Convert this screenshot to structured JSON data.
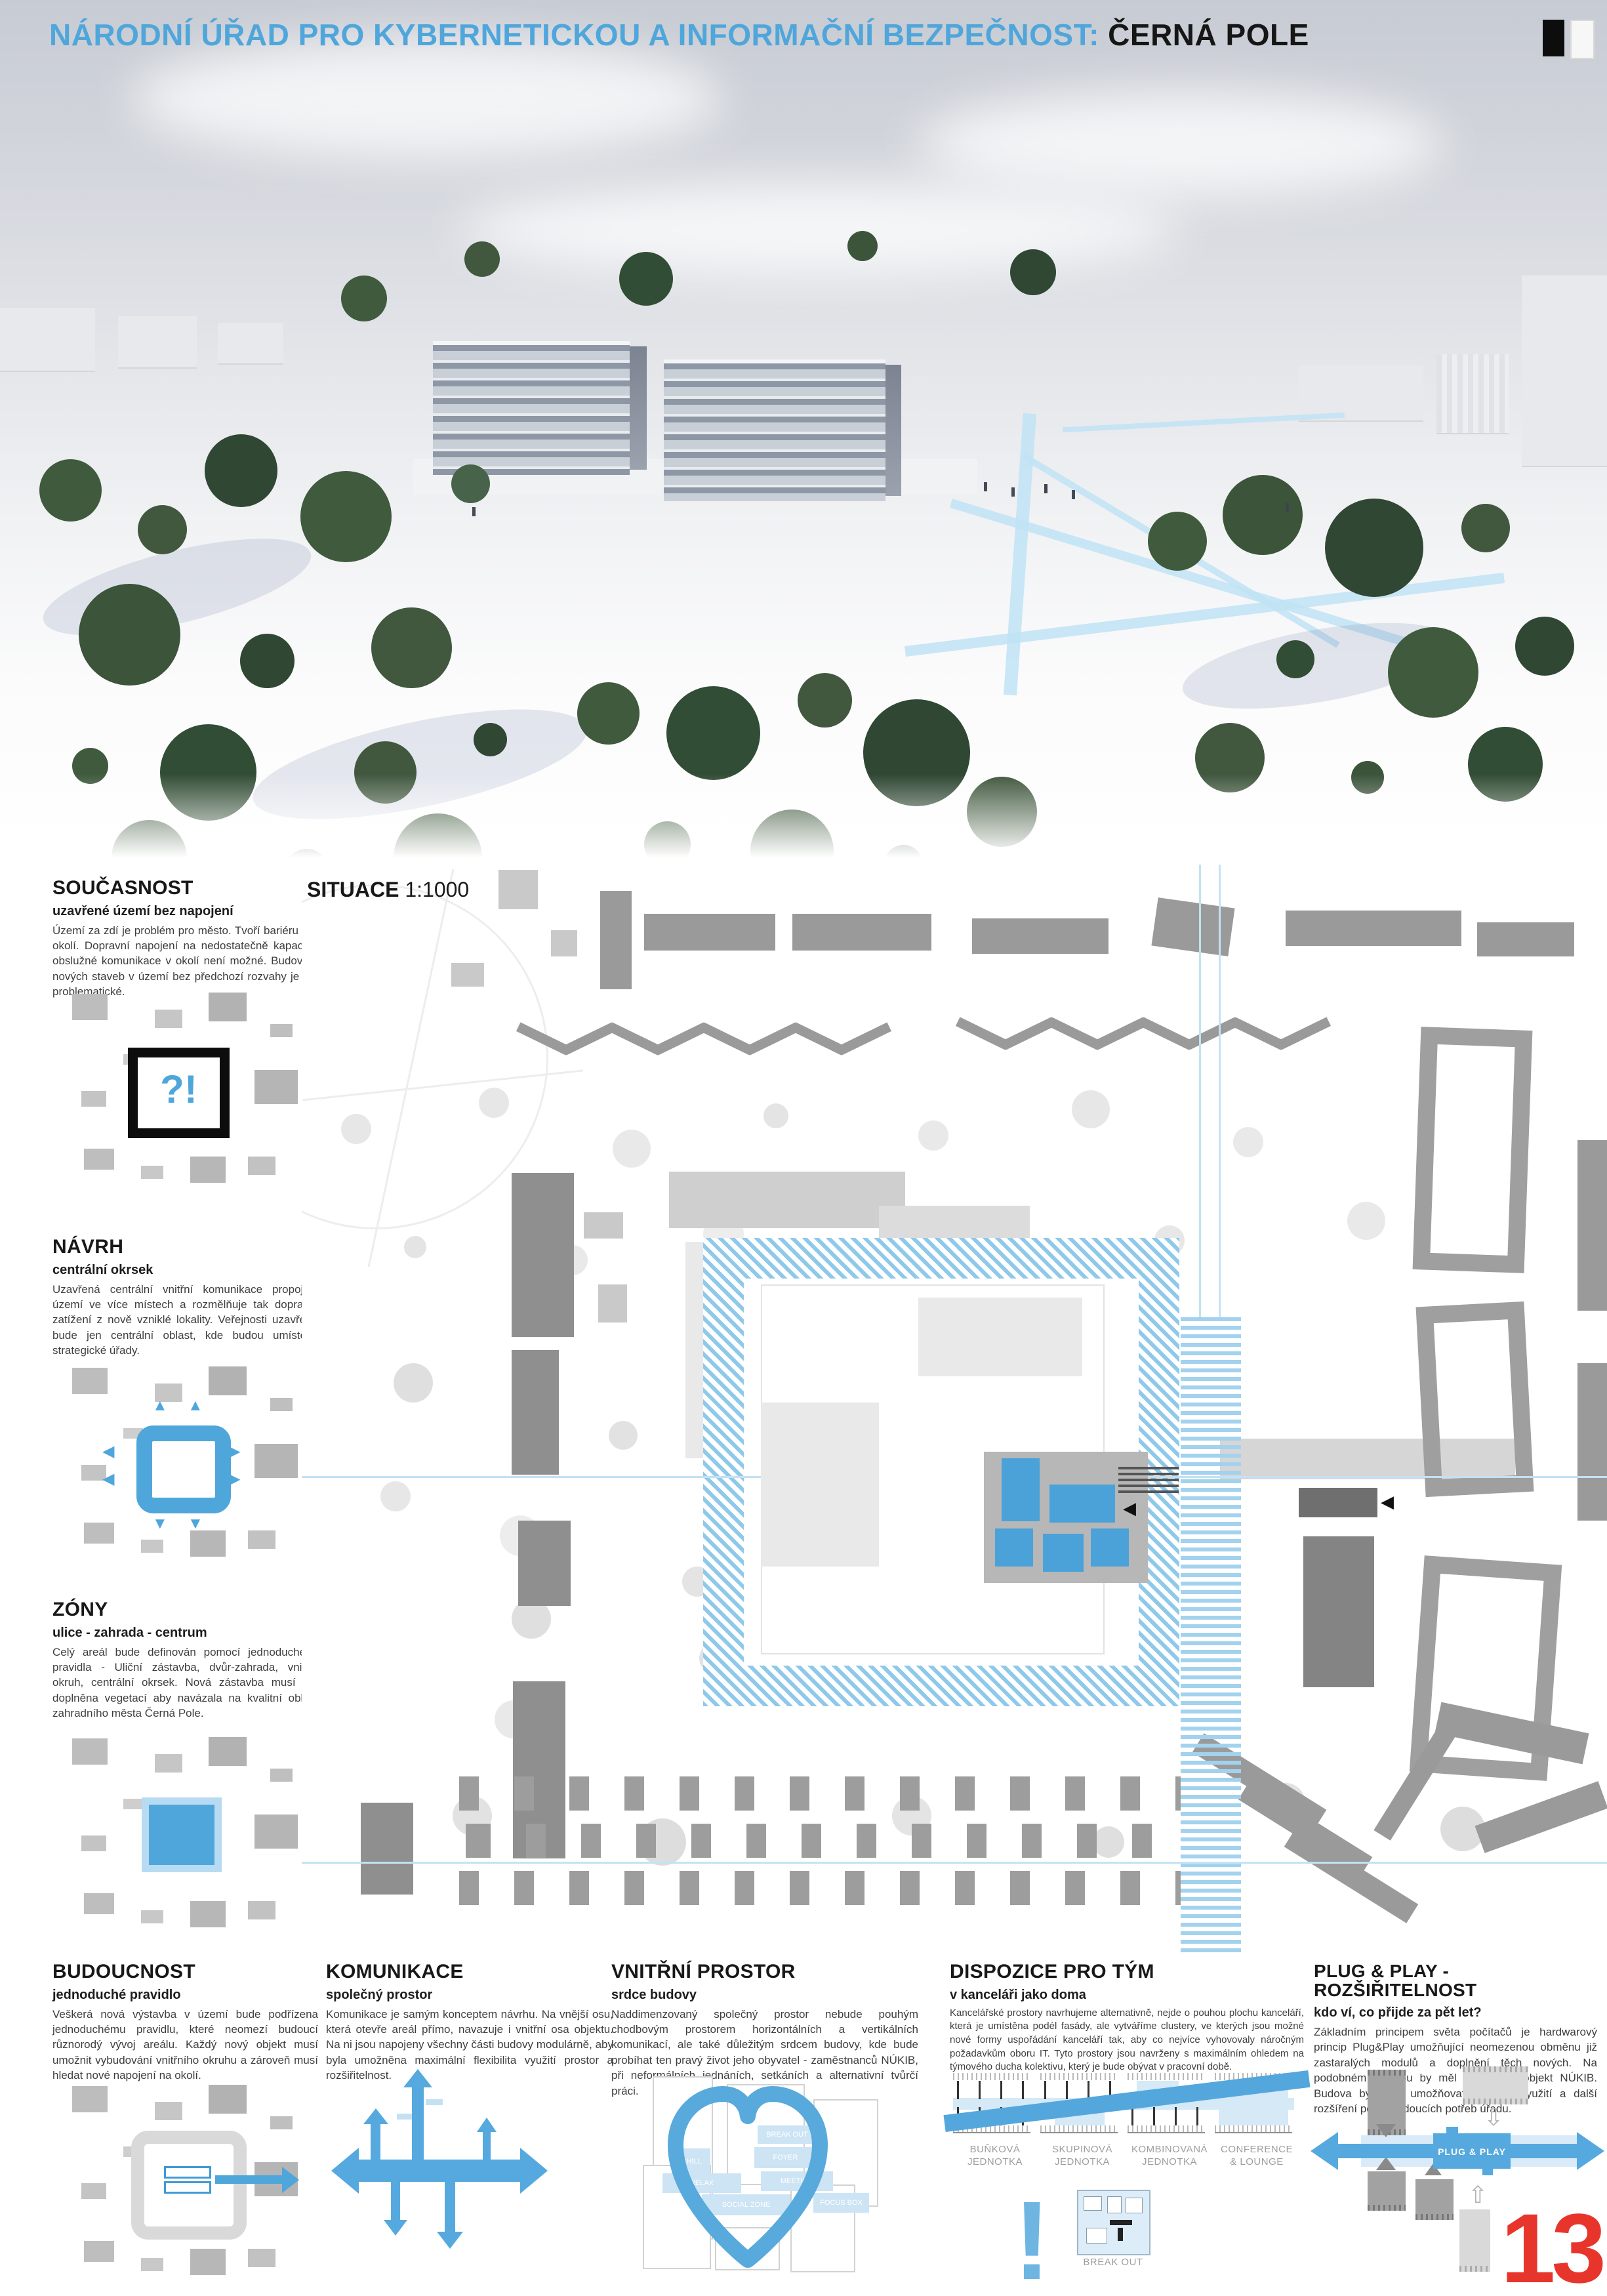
{
  "header": {
    "title_blue": "NÁRODNÍ ÚŘAD PRO KYBERNETICKOU A INFORMAČNÍ BEZPEČNOST:",
    "title_black": "ČERNÁ POLE"
  },
  "situace": {
    "label": "SITUACE",
    "scale": "1:1000"
  },
  "side": [
    {
      "title": "SOUČASNOST",
      "subtitle": "uzavřené území bez napojení",
      "body": "Území za zdí je problém pro město. Tvoří bariéru pro okolí. Dopravní napojení na nedostatečně kapacitní obslužné komunikace v okolí není možné. Budování nových staveb v území bez předchozí rozvahy je tak problematické.",
      "symbol": "?!"
    },
    {
      "title": "NÁVRH",
      "subtitle": "centrální okrsek",
      "body": "Uzavřená centrální vnitřní komunikace propojuje území ve více místech a rozmělňuje tak dopravní zatížení z nově vzniklé lokality. Veřejnosti uzavřená bude jen centrální oblast, kde budou umístěny strategické úřady."
    },
    {
      "title": "ZÓNY",
      "subtitle": "ulice - zahrada - centrum",
      "body": "Celý areál bude definován pomocí jednoduchého pravidla - Uliční zástavba, dvůr-zahrada, vnitřní okruh, centrální okrsek. Nová zástavba musí být doplněna vegetací aby navázala na kvalitní oblast zahradního města Černá Pole."
    }
  ],
  "bottom": [
    {
      "title": "BUDOUCNOST",
      "subtitle": "jednoduché pravidlo",
      "body": "Veškerá nová výstavba v území bude podřízena jednoduchému pravidlu, které neomezí budoucí různorodý vývoj areálu. Každý nový objekt musí umožnit vybudování vnitřního okruhu a zároveň musí hledat nové napojení na okolí."
    },
    {
      "title": "KOMUNIKACE",
      "subtitle": "společný prostor",
      "body": "Komunikace je samým konceptem návrhu. Na vnější osu, která otevře areál přímo, navazuje i vnitřní osa objektu. Na ni jsou napojeny všechny části budovy modulárně, aby byla umožněna maximální flexibilita využití prostor a rozšiřitelnost."
    },
    {
      "title": "VNITŘNÍ PROSTOR",
      "subtitle": "srdce budovy",
      "body": "Naddimenzovaný společný prostor nebude pouhým chodbovým prostorem horizontálních a vertikálních komunikací, ale také důležitým srdcem budovy, kde bude probíhat ten pravý život jeho obyvatel - zaměstnanců NÚKIB, při neformálních jednáních, setkáních a alternativní tvůrčí práci."
    },
    {
      "title": "DISPOZICE PRO TÝM",
      "subtitle": "v kanceláři jako doma",
      "body": "Kancelářské prostory navrhujeme alternativně, nejde o pouhou plochu kanceláří, která je umístěna podél fasády, ale vytváříme clustery, ve kterých jsou možné nové formy uspořádání kanceláří tak, aby co nejvíce vyhovovaly náročným požadavkům oboru IT. Tyto prostory jsou navrženy s maximálním ohledem na týmového ducha kolektivu, který je bude obývat v pracovní době."
    },
    {
      "title": "PLUG & PLAY - ROZŠIŘITELNOST",
      "subtitle": "kdo ví, co přijde za pět let?",
      "body": "Základním principem světa počítačů je hardwarový princip Plug&Play umožňující neomezenou obměnu již zastaralých modulů a doplnění těch nových. Na podobném principu by měl fungovat i objekt NÚKIB. Budova by měla umožňovat flexibilní využití a další rozšíření podle budoucích potřeb úřadu."
    }
  ],
  "dispozice": {
    "units": [
      {
        "l1": "BUŇKOVÁ",
        "l2": "JEDNOTKA"
      },
      {
        "l1": "SKUPINOVÁ",
        "l2": "JEDNOTKA"
      },
      {
        "l1": "KOMBINOVANÁ",
        "l2": "JEDNOTKA"
      },
      {
        "l1": "CONFERENCE",
        "l2": "& LOUNGE"
      }
    ],
    "exclamation": "!",
    "breakout": "BREAK OUT"
  },
  "heart": {
    "zones": [
      "BREAK OUT",
      "CHILL",
      "FOYER",
      "RELAX",
      "MEETING",
      "SOCIAL ZONE",
      "FOCUS BOX"
    ]
  },
  "plug": {
    "label": "PLUG & PLAY"
  },
  "page": {
    "number": "13"
  },
  "colors": {
    "accent": "#4FA6DB",
    "red": "#E8352B",
    "building_gray": "#9A9A9A"
  }
}
